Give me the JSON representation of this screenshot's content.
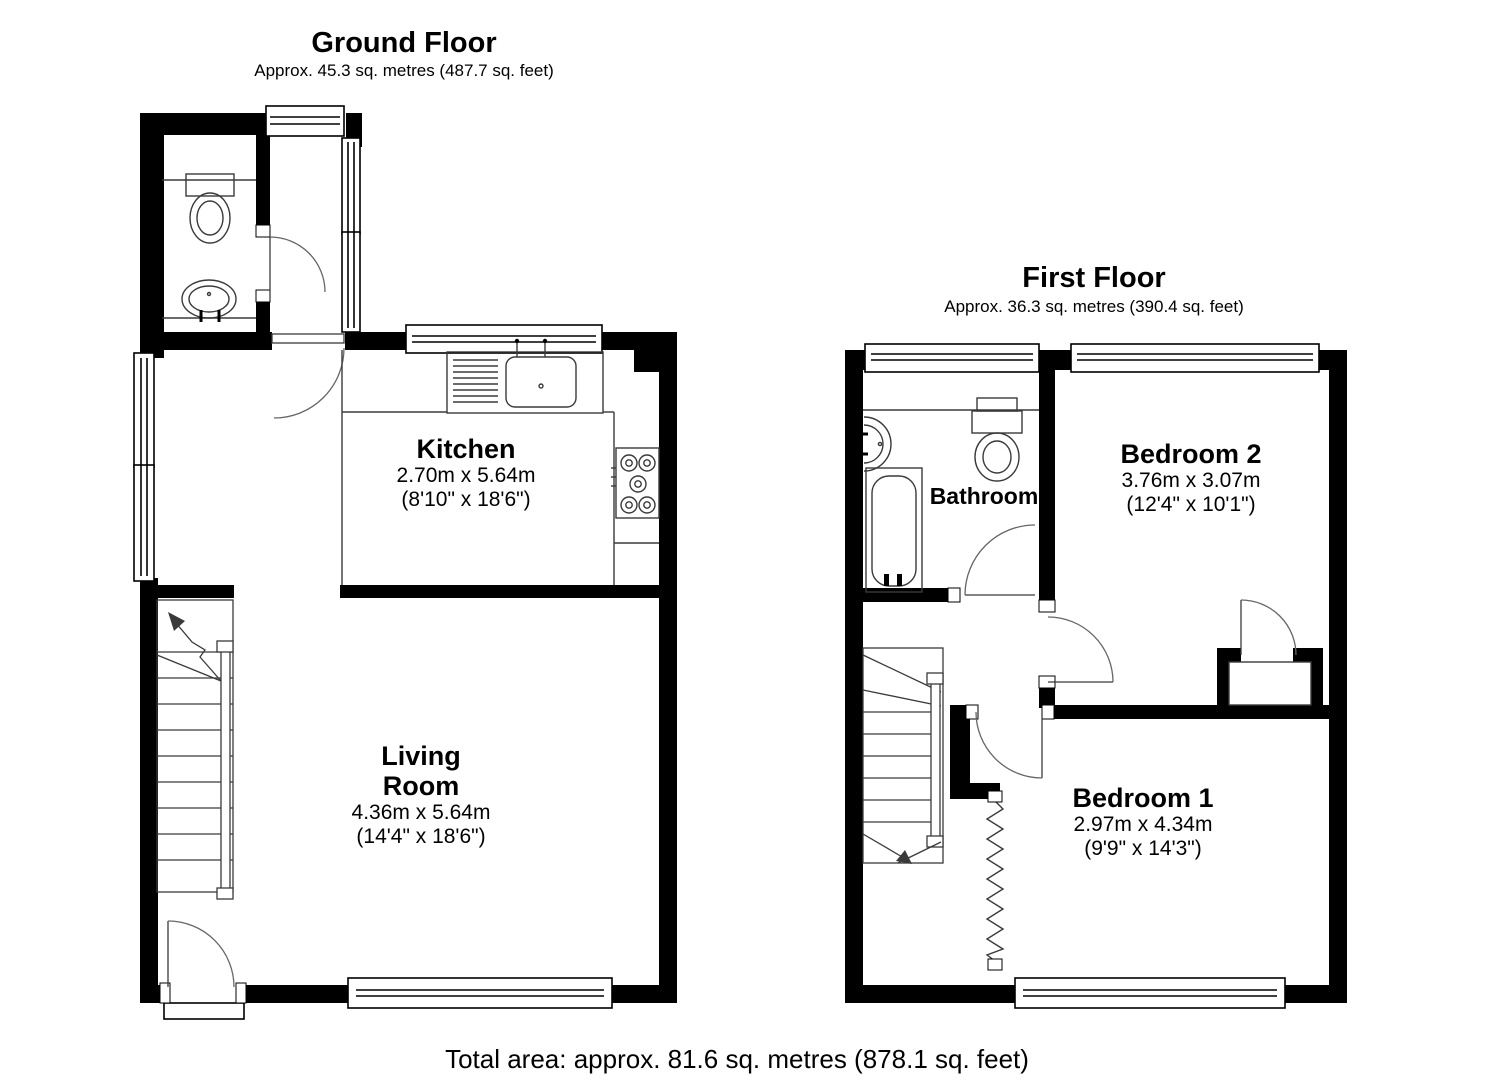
{
  "ground_floor": {
    "title": "Ground Floor",
    "subtitle": "Approx. 45.3 sq. metres (487.7 sq. feet)",
    "rooms": {
      "kitchen": {
        "name": "Kitchen",
        "size_metric": "2.70m x 5.64m",
        "size_imperial": "(8'10\" x 18'6\")"
      },
      "living_room": {
        "name_line1": "Living",
        "name_line2": "Room",
        "size_metric": "4.36m x 5.64m",
        "size_imperial": "(14'4\" x 18'6\")"
      }
    }
  },
  "first_floor": {
    "title": "First Floor",
    "subtitle": "Approx. 36.3 sq. metres (390.4 sq. feet)",
    "rooms": {
      "bathroom": {
        "name": "Bathroom"
      },
      "bedroom_2": {
        "name": "Bedroom 2",
        "size_metric": "3.76m x 3.07m",
        "size_imperial": "(12'4\" x 10'1\")"
      },
      "bedroom_1": {
        "name": "Bedroom 1",
        "size_metric": "2.97m x 4.34m",
        "size_imperial": "(9'9\" x 14'3\")"
      }
    }
  },
  "footer": {
    "total_area": "Total area: approx. 81.6 sq. metres (878.1 sq. feet)"
  },
  "colors": {
    "wall": "#000000",
    "line": "#3a3a3a",
    "door_arc": "#666666"
  }
}
